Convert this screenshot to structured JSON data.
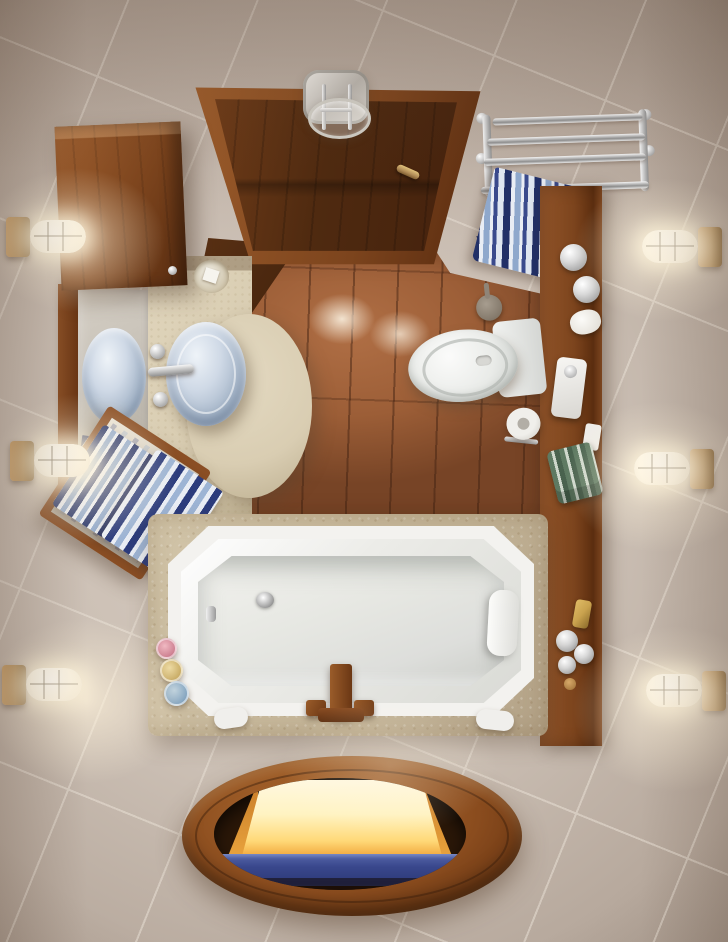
{
  "meta": {
    "title": "Top-down 3D render of a small bathroom",
    "type": "natural-image",
    "view": "bird's-eye / plan view",
    "text_content": "none visible"
  },
  "colors": {
    "wall": "#cbbfb4",
    "wallHi": "#d8cdc2",
    "wallLo": "#a4968a",
    "seam": "#ece4d9",
    "wood": "#7c441d",
    "woodHi": "#9c5c2b",
    "woodLo": "#56290e",
    "doorWood": "#4f2a10",
    "terracotta": "#9c5e37",
    "terracottaLo": "#774426",
    "white": "#f3f2ef",
    "basin": "#dddedb",
    "porcelainLo": "#c7cbc7",
    "counter": "#d9cdb2",
    "counterLo": "#bcae8f",
    "glass": "#9fb0c4",
    "glassHi": "#eef3f8",
    "chromeHi": "#f5f5f5",
    "chromeLo": "#8f8f8f",
    "brass": "#b08a56",
    "brassLo": "#7d5c30",
    "navy": "#223067",
    "towelBlue": "#8fa8cc",
    "towelWhite": "#e9edf4",
    "green": "#5e7a62",
    "gold": "#c9a24e",
    "glow": "#fff3db",
    "hatchGlow": "#fff8e0",
    "hatchAmber": "#f2a93e",
    "stepBlue": "#39478c"
  },
  "scene": {
    "labels": {
      "room": "Small bathroom seen from directly above, beige stone tiles",
      "door": "Open dark-wood door at top center with brass handle",
      "lamp": "Chrome ceiling lamp beside the door",
      "terracotta": "Terracotta tiled floor zone inside the doorway",
      "radiator": "Chrome towel radiator on the top-right wall",
      "radTowel": "Blue and white striped towel hanging on the radiator",
      "shelf": "Vertical wooden shelf ledge along the right side with toiletries",
      "scale": "White bathroom scale on the wooden ledge",
      "greenTowels": "Folded green striped towels on the wooden ledge",
      "toilet": "White toilet with tank, seen from above on terracotta tiles",
      "paper": "Toilet paper roll holder below the tank",
      "brush": "Toilet brush beside the wall",
      "cabinet": "Wall-mounted wooden cabinet at top left",
      "mirror": "Mirror strip on the left wall reflecting the sink",
      "sink": "Frosted glass vessel sink on curved beige stone counter",
      "sinkReflection": "Mirror reflection of the glass vessel sink",
      "faucet": "Chrome faucet with cross handles",
      "soapDish": "Round soap dish on the counter",
      "towels": "Two navy and light-blue striped towels on the counter rail",
      "leanMirror": "Small wood-framed mirror leaning by the towels",
      "tub": "White rectangular bathtub with clipped corners on a beige stone platform",
      "headrest": "White bath pillow at the right end of the tub",
      "drain": "Chrome drain in the tub floor",
      "tubFaucet": "Wood and bronze deck-mounted tub faucet",
      "bottles": "Pink, yellow and blue bath bottles beside the tub",
      "hatch": "Oval wooden-rimmed stairwell opening in the floor",
      "glowWall": "Warm glowing light rising from the stairwell",
      "step": "Blue carpeted step visible inside the stairwell",
      "sconce": "Brass bulkhead wall light with glowing white glass",
      "sconceCount": "Six wall sconces, three per side wall"
    }
  }
}
